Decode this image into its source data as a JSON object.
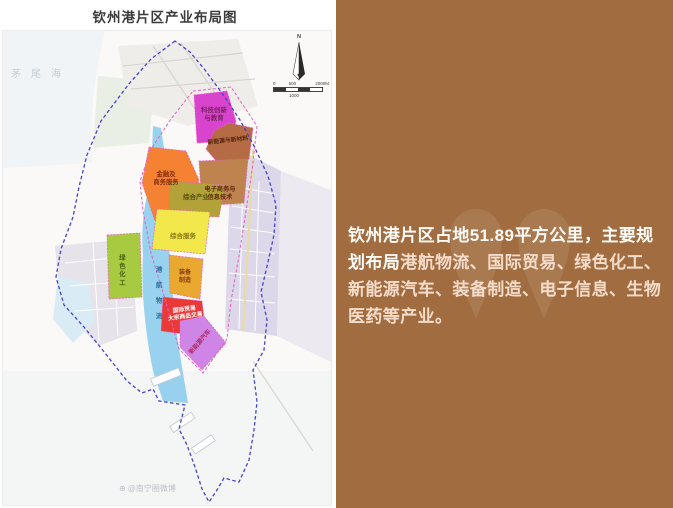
{
  "left_panel": {
    "title": "钦州港片区产业布局图",
    "map": {
      "sea_label": "茅尾海",
      "compass_n": "N",
      "scale_bar": {
        "tick_0": "0",
        "tick_500": "500",
        "tick_2000": "2000M",
        "tick_1000": "1000"
      },
      "zones": {
        "tech_innovation": {
          "lines": [
            "科技创新",
            "与教育"
          ],
          "color": "#d944ce"
        },
        "new_energy_materials": {
          "lines": [
            "新能源与新材料"
          ],
          "color": "#b56b44"
        },
        "finance_business": {
          "lines": [
            "金融及",
            "商务服务"
          ],
          "color": "#f58233"
        },
        "ecommerce_it": {
          "lines": [
            "电子商务与",
            "信息技术"
          ],
          "color": "#bf8350"
        },
        "comprehensive_industry": {
          "lines": [
            "综合产业"
          ],
          "color": "#b2a237"
        },
        "comprehensive_service": {
          "lines": [
            "综合服务"
          ],
          "color": "#f3e84b"
        },
        "green_chemical": {
          "lines": [
            "绿色化工"
          ],
          "color": "#a8ca41"
        },
        "port_logistics": {
          "lines": [
            "港航物流"
          ],
          "color": "#8ecdec"
        },
        "equipment_mfg": {
          "lines": [
            "装备",
            "制造"
          ],
          "color": "#e9a92e"
        },
        "intl_trade": {
          "lines": [
            "国际贸易",
            "大宗商品交易"
          ],
          "color": "#e93a38"
        },
        "new_energy_vehicles": {
          "lines": [
            "新能源汽车"
          ],
          "color": "#cf85e6"
        }
      },
      "watermark": {
        "icon": "⊕",
        "text": "@南宁圈微博"
      }
    }
  },
  "right_panel": {
    "bg_color": "#a16c3f",
    "description_intro": "钦州港片区占地51.89平方公里，主要规划布局",
    "description_industries": "港航物流、国际贸易、绿色化工、新能源汽车、装备制造、电子信息、生物医药等产业。"
  }
}
